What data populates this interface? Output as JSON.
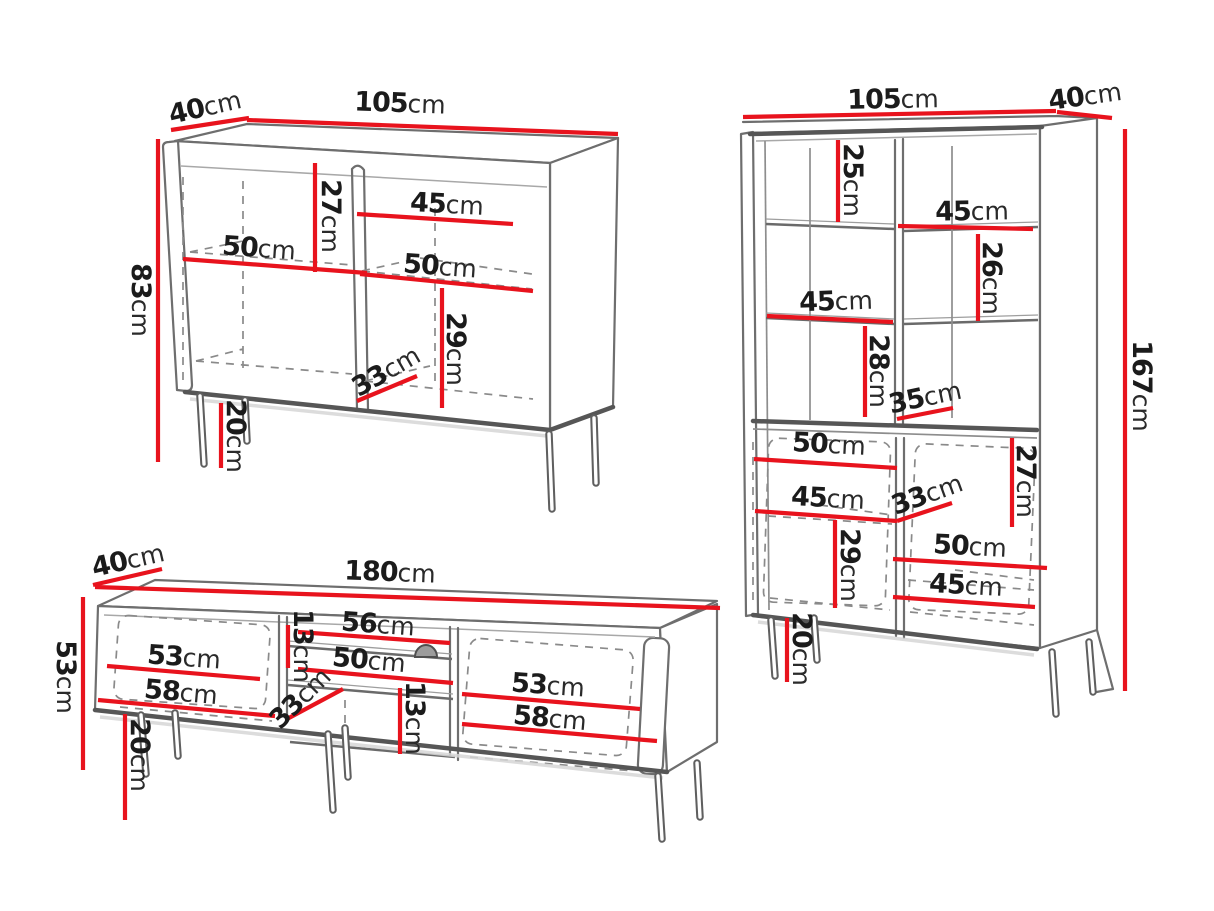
{
  "unit": "cm",
  "colors": {
    "background": "#ffffff",
    "dimension_line": "#e8131d",
    "outline": "#6e6e6e",
    "text": "#1b1b1b"
  },
  "sideboard": {
    "width_cm": "105",
    "depth_cm": "40",
    "height_cm": "83",
    "upper_inner_height_cm": "27",
    "right_shelf_width_cm": "45",
    "left_shelf_width_cm": "50",
    "right_lower_shelf_width_cm": "50",
    "lower_inner_height_cm": "29",
    "inner_depth_cm": "33",
    "leg_height_cm": "20"
  },
  "tall_cabinet": {
    "width_cm": "105",
    "depth_cm": "40",
    "height_cm": "167",
    "top_section_height_cm": "25",
    "right_shelf_width_cm": "45",
    "right_section_height_cm": "26",
    "left_shelf_width_cm": "45",
    "left_section_height_cm": "28",
    "inner_depth_upper_cm": "35",
    "left_door_shelf_width_cm": "50",
    "right_door_section_height_cm": "27",
    "left_door_lower_shelf_width_cm": "45",
    "inner_depth_lower_cm": "33",
    "left_door_section_height_cm": "29",
    "right_door_shelf_width_cm": "50",
    "right_door_lower_shelf_width_cm": "45",
    "leg_height_cm": "20"
  },
  "tv_stand": {
    "width_cm": "180",
    "depth_cm": "40",
    "height_cm": "53",
    "niche_top_height_cm": "13",
    "niche_top_width_cm": "56",
    "niche_width_cm": "50",
    "left_shelf_width_cm": "53",
    "left_lower_width_cm": "58",
    "inner_depth_cm": "33",
    "niche_bottom_height_cm": "13",
    "right_shelf_width_cm": "53",
    "right_lower_width_cm": "58",
    "leg_height_cm": "20"
  }
}
